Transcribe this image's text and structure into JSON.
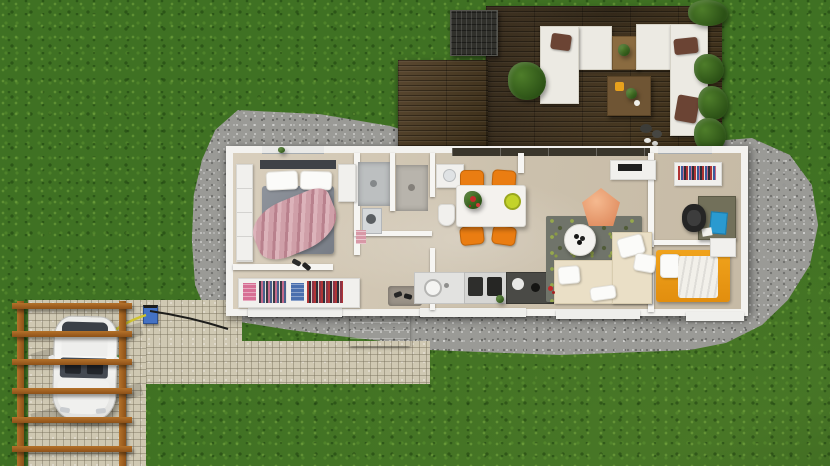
{
  "scene": {
    "title": "3D floor plan render — single-storey house with terrace, carport and garden",
    "description": "Top-down 3D architectural render: white-walled rectangular house with open-plan kitchen, dining and living area, two bedrooms, bathroom and walk-in wardrobe; large dark-wood terrace with two white corner sofas; gravel surround; paved walkway; timber pergola carport with an electric car on charge.",
    "palette": {
      "grass": "#3f7123",
      "grass_fleck_light": "#8dbd4c",
      "grass_fleck_dark": "#1a3d0e",
      "gravel": "#9a9a96",
      "deck_wood": "#4a3a24",
      "house_wall": "#f3f2ef",
      "house_floor": "#d0c5b1",
      "paver": "#cfc8b2",
      "pergola_wood": "#a8661f",
      "dining_chair_orange": "#ea7d12",
      "bed_blanket_rose": "#c6939e",
      "bed2_cover_orange": "#eb9a15",
      "sofa_beige": "#eadfc6",
      "pouf_salmon": "#efa77d",
      "laptop_blue": "#2a9ad0",
      "cable_yellow": "#cfc32f",
      "cable_green": "#4f9e35",
      "charger_blue": "#4472c4"
    }
  },
  "terrace": {
    "items": [
      "storage planter",
      "corner sofa left",
      "corner sofa right",
      "wooden side table",
      "wooden coffee table",
      "potted plants",
      "decorative rocks"
    ]
  },
  "house": {
    "rooms": [
      {
        "name": "master bedroom",
        "items": [
          "double bed",
          "rose throw blanket",
          "wardrobe shelving",
          "open closet with clothes",
          "shoes"
        ]
      },
      {
        "name": "bathroom",
        "items": [
          "walk-in shower",
          "washing machine",
          "pink towels",
          "second shower room",
          "vanity sink",
          "toilet"
        ]
      },
      {
        "name": "entry",
        "items": [
          "doormat",
          "shoes",
          "entrance steps"
        ]
      },
      {
        "name": "kitchen dining",
        "items": [
          "white dining table",
          "four orange chairs",
          "table plant",
          "fruit bowl",
          "kitchen counter with sink",
          "cooktop",
          "dark worktop"
        ]
      },
      {
        "name": "living room",
        "items": [
          "patterned area rug",
          "round coffee table",
          "salmon pouf",
          "beige corner sofa",
          "tv sideboard"
        ]
      },
      {
        "name": "office",
        "items": [
          "open wardrobe with clothes",
          "desk",
          "blue laptop",
          "black office chair",
          "white cabinet"
        ]
      },
      {
        "name": "second bedroom",
        "items": [
          "single bed with orange cover",
          "white nightstand"
        ]
      }
    ]
  },
  "carport": {
    "items": [
      "timber pergola",
      "white electric car",
      "ev charging station",
      "yellow charging cable",
      "green coiled cable",
      "paved pad",
      "paved walkway"
    ]
  }
}
